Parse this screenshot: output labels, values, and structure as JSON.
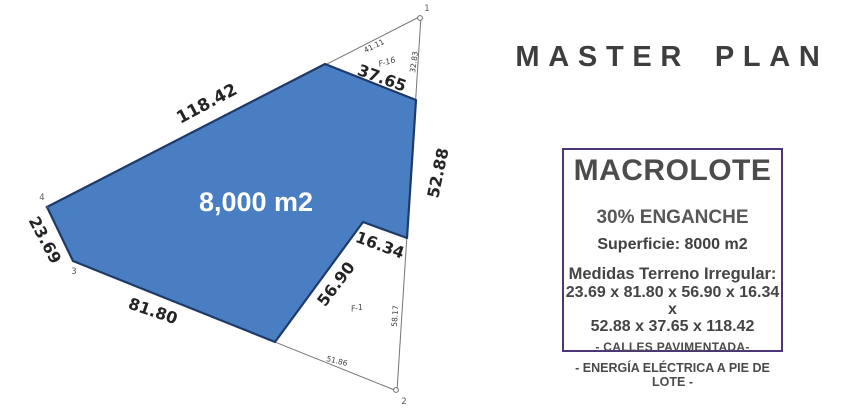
{
  "master_plan_title": "MASTER PLAN",
  "plot": {
    "area_label": "8,000 m2",
    "colors": {
      "lot_fill": "#4a7ec3",
      "lot_stroke": "#1e3a69",
      "outline_line": "#757575",
      "area_text": "#ffffff"
    },
    "edges": {
      "nw": "118.42",
      "top_tri_upper": "41.11",
      "top_tri_right": "32.83",
      "top_cut": "37.65",
      "east": "52.88",
      "notch_top": "16.34",
      "notch_left": "56.90",
      "south": "81.80",
      "west": "23.69",
      "lower_tri_right": "58.17",
      "lower_tri_bottom": "51.86"
    },
    "parcels": {
      "f16": "F-16",
      "f1": "F-1"
    },
    "vertices": {
      "v1": "1",
      "v2": "2",
      "v3": "3",
      "v4": "4"
    }
  },
  "info_box": {
    "title": "MACROLOTE",
    "enganche": "30% ENGANCHE",
    "superficie": "Superficie: 8000 m2",
    "medidas_heading": "Medidas Terreno Irregular:",
    "medidas_line1": "23.69 x 81.80 x 56.90 x 16.34 x",
    "medidas_line2": "52.88 x 37.65 x 118.42",
    "calles": "- CALLES PAVIMENTADA-",
    "energia": "- ENERGÍA ELÉCTRICA A PIE DE LOTE -",
    "border_color": "#4c3677",
    "text_color": "#4a4a4a"
  }
}
